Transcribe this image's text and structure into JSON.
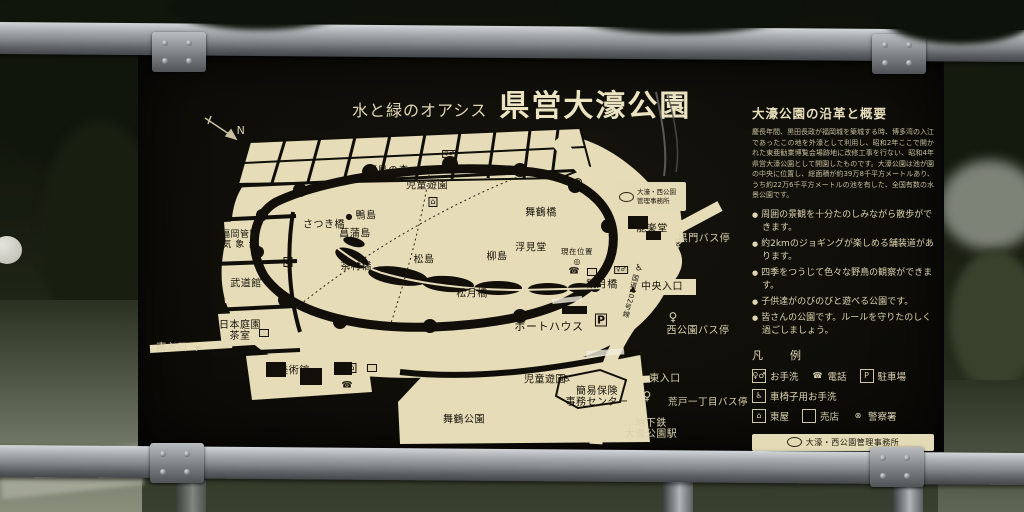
{
  "sign": {
    "title": {
      "prefix": "水と緑のオアシス",
      "main": "県営大濠公園"
    },
    "map": {
      "compass": "N",
      "office_box": "大濠・西公園\n管理事務所",
      "labels": [
        {
          "text": "野鳥の森",
          "x": 388,
          "y": 171,
          "size": 10,
          "tone": "dark"
        },
        {
          "text": "児童遊園",
          "x": 427,
          "y": 186,
          "size": 10,
          "tone": "dark"
        },
        {
          "text": "舞鶴橋",
          "x": 541,
          "y": 213,
          "size": 10,
          "tone": "dark"
        },
        {
          "text": "鴨島",
          "x": 366,
          "y": 216,
          "size": 10,
          "tone": "dark"
        },
        {
          "text": "さつき橋",
          "x": 324,
          "y": 225,
          "size": 10,
          "tone": "dark"
        },
        {
          "text": "菖蒲島",
          "x": 355,
          "y": 234,
          "size": 10,
          "tone": "dark"
        },
        {
          "text": "福岡管区\n気 象 台",
          "x": 240,
          "y": 241,
          "size": 9,
          "tone": "dark"
        },
        {
          "text": "武道館",
          "x": 246,
          "y": 284,
          "size": 10,
          "tone": "dark"
        },
        {
          "text": "茶村橋",
          "x": 356,
          "y": 267,
          "size": 10,
          "tone": "dark"
        },
        {
          "text": "松島",
          "x": 424,
          "y": 260,
          "size": 10,
          "tone": "dark"
        },
        {
          "text": "柳島",
          "x": 497,
          "y": 257,
          "size": 10,
          "tone": "dark"
        },
        {
          "text": "浮見堂",
          "x": 531,
          "y": 248,
          "size": 10,
          "tone": "dark"
        },
        {
          "text": "現在位置",
          "x": 577,
          "y": 252,
          "size": 7.5,
          "tone": "dark"
        },
        {
          "text": "能楽堂",
          "x": 652,
          "y": 229,
          "size": 10,
          "tone": "dark"
        },
        {
          "text": "松月橋",
          "x": 472,
          "y": 294,
          "size": 10,
          "tone": "dark"
        },
        {
          "text": "観月橋",
          "x": 602,
          "y": 285,
          "size": 10,
          "tone": "dark"
        },
        {
          "text": "中央入口",
          "x": 662,
          "y": 287,
          "size": 10,
          "tone": "dark"
        },
        {
          "text": "黒門バス停",
          "x": 704,
          "y": 239,
          "size": 10,
          "tone": "light"
        },
        {
          "text": "西公園バス停",
          "x": 698,
          "y": 331,
          "size": 10,
          "tone": "light"
        },
        {
          "text": "ボートハウス",
          "x": 549,
          "y": 327,
          "size": 11,
          "tone": "dark"
        },
        {
          "text": "日本庭園\n茶室",
          "x": 240,
          "y": 331,
          "size": 10,
          "tone": "dark"
        },
        {
          "text": "南入口",
          "x": 172,
          "y": 348,
          "size": 10,
          "tone": "light"
        },
        {
          "text": "美術館",
          "x": 294,
          "y": 371,
          "size": 10,
          "tone": "dark"
        },
        {
          "text": "児童遊園",
          "x": 545,
          "y": 380,
          "size": 10,
          "tone": "dark"
        },
        {
          "text": "簡易保険\n事務センター",
          "x": 597,
          "y": 397,
          "size": 10,
          "tone": "dark"
        },
        {
          "text": "東入口",
          "x": 665,
          "y": 379,
          "size": 10,
          "tone": "light"
        },
        {
          "text": "荒戸一丁目バス停",
          "x": 708,
          "y": 403,
          "size": 9.5,
          "tone": "light"
        },
        {
          "text": "地下鉄\n大濠公園駅",
          "x": 651,
          "y": 429,
          "size": 10,
          "tone": "light"
        },
        {
          "text": "舞鶴公園",
          "x": 464,
          "y": 420,
          "size": 10,
          "tone": "dark"
        },
        {
          "text": "国道202号線",
          "x": 630,
          "y": 296,
          "size": 7,
          "tone": "dark",
          "vertical": true,
          "rot": 14
        },
        {
          "text": "N",
          "x": 241,
          "y": 131,
          "size": 11,
          "tone": "light"
        }
      ],
      "icons": [
        {
          "name": "police-icon",
          "glyph": "⊗",
          "x": 578,
          "y": 183,
          "tone": "dark",
          "size": 13
        },
        {
          "name": "gazebo-icon",
          "glyph": "⌂",
          "x": 433,
          "y": 202,
          "tone": "dark",
          "size": 8,
          "boxed": true
        },
        {
          "name": "toilet-icon",
          "glyph": "♀♂",
          "x": 449,
          "y": 154,
          "tone": "dark",
          "size": 6,
          "boxed": true
        },
        {
          "name": "phone-icon",
          "glyph": "☎",
          "x": 574,
          "y": 272,
          "tone": "dark",
          "size": 9
        },
        {
          "name": "shop-icon",
          "glyph": "　",
          "x": 592,
          "y": 272,
          "tone": "dark",
          "size": 6,
          "boxed": true
        },
        {
          "name": "toilet-icon",
          "glyph": "♀♂",
          "x": 621,
          "y": 270,
          "tone": "dark",
          "size": 6,
          "boxed": true
        },
        {
          "name": "wheelchair-icon",
          "glyph": "♿",
          "x": 639,
          "y": 269,
          "tone": "dark",
          "size": 9
        },
        {
          "name": "gazebo-icon",
          "glyph": "⌂",
          "x": 288,
          "y": 262,
          "tone": "dark",
          "size": 8,
          "boxed": true
        },
        {
          "name": "shop-icon",
          "glyph": "　",
          "x": 264,
          "y": 333,
          "tone": "dark",
          "size": 6,
          "boxed": true
        },
        {
          "name": "gazebo-icon",
          "glyph": "⌂",
          "x": 352,
          "y": 368,
          "tone": "dark",
          "size": 8,
          "boxed": true
        },
        {
          "name": "shop-icon",
          "glyph": "　",
          "x": 372,
          "y": 368,
          "tone": "dark",
          "size": 6,
          "boxed": true
        },
        {
          "name": "phone-icon",
          "glyph": "☎",
          "x": 347,
          "y": 386,
          "tone": "dark",
          "size": 9
        },
        {
          "name": "wheelchair-icon",
          "glyph": "♿",
          "x": 567,
          "y": 380,
          "tone": "dark",
          "size": 9
        },
        {
          "name": "parking-icon",
          "glyph": "P",
          "x": 601,
          "y": 320,
          "tone": "dark",
          "size": 11,
          "boxed": true,
          "bold": true
        },
        {
          "name": "bus-stop-icon",
          "glyph": "♀",
          "x": 678,
          "y": 243,
          "tone": "light",
          "size": 12
        },
        {
          "name": "bus-stop-icon",
          "glyph": "♀",
          "x": 673,
          "y": 317,
          "tone": "light",
          "size": 12
        },
        {
          "name": "bus-stop-icon",
          "glyph": "♀",
          "x": 647,
          "y": 396,
          "tone": "light",
          "size": 12
        },
        {
          "name": "entrance-arrow-icon",
          "glyph": "▶",
          "x": 199,
          "y": 348,
          "tone": "light",
          "size": 8
        },
        {
          "name": "entrance-marker-icon",
          "glyph": "▲",
          "x": 633,
          "y": 289,
          "tone": "dark",
          "size": 8
        },
        {
          "name": "current-location-icon",
          "glyph": "◎",
          "x": 577,
          "y": 262,
          "tone": "dark",
          "size": 8
        },
        {
          "name": "island-dot-icon",
          "glyph": "●",
          "x": 349,
          "y": 217,
          "tone": "dark",
          "size": 8
        }
      ]
    },
    "info": {
      "heading": "大濠公園の沿革と概要",
      "body": "慶長年間、黒田長政が福岡城を築城する時、博多湾の入江であったこの地を外濠として利用し、昭和2年ここで開かれた東亜勧業博覧会場跡地に改修工事を行ない、昭和4年県営大濠公園として開園したものです。大濠公園は池が園の中央に位置し、総面積が約39万8千平方メートルあり、うち約22万6千平方メートルの池を有した、全国有数の水景公園です。",
      "bullets": [
        "周囲の景観を十分たのしみながら散歩ができます。",
        "約2kmのジョギングが楽しめる舗装道があります。",
        "四季をつうじて色々な野鳥の観察ができます。",
        "子供達がのびのびと遊べる公園です。",
        "皆さんの公園です。ルールを守りたのしく過ごしましょう。"
      ]
    },
    "legend": {
      "heading": "凡　例",
      "rows": [
        [
          {
            "name": "toilet-icon",
            "glyph": "♀♂",
            "boxed": true,
            "label": "お手洗"
          },
          {
            "name": "phone-icon",
            "glyph": "☎",
            "boxed": false,
            "label": "電話"
          },
          {
            "name": "parking-icon",
            "glyph": "P",
            "boxed": true,
            "label": "駐車場"
          }
        ],
        [
          {
            "name": "wheelchair-icon",
            "glyph": "♿",
            "boxed": true,
            "label": "車椅子用お手洗"
          }
        ],
        [
          {
            "name": "gazebo-icon",
            "glyph": "⌂",
            "boxed": true,
            "label": "東屋"
          },
          {
            "name": "shop-icon",
            "glyph": "　",
            "boxed": true,
            "label": "売店"
          },
          {
            "name": "police-icon",
            "glyph": "⊗",
            "boxed": false,
            "label": "警察署"
          }
        ]
      ]
    },
    "office_label": "大濠・西公園管理事務所",
    "phone_icon": "☎",
    "phone": "741−2004"
  }
}
